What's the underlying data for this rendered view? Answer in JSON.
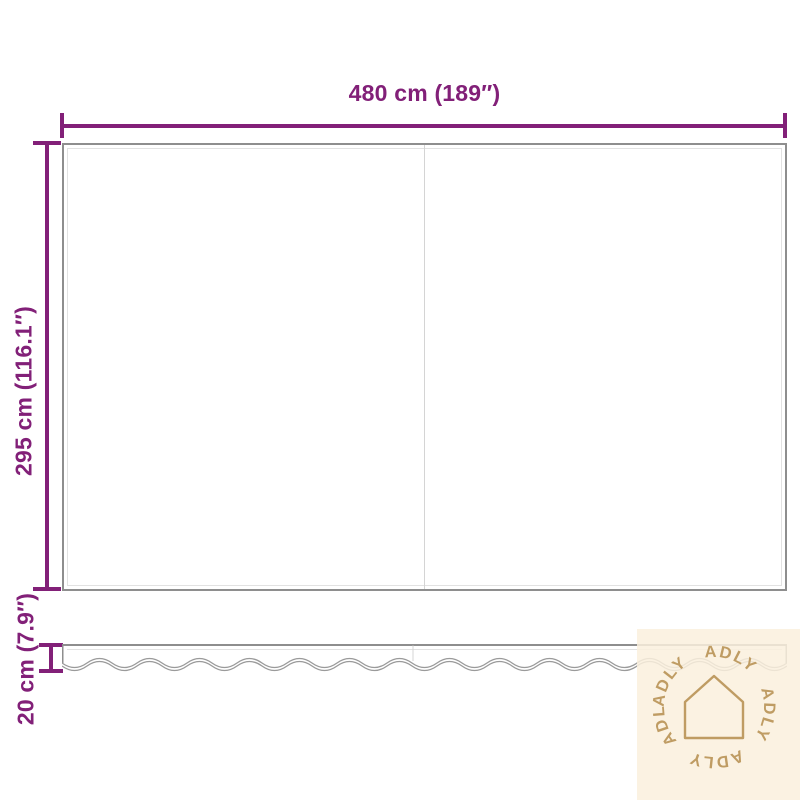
{
  "dimensions": {
    "width_label": "480 cm (189″)",
    "height_label": "295 cm (116.1″)",
    "valance_height_label": "20 cm (7.9″)"
  },
  "watermark": {
    "brand": "ADLY",
    "ring_text": "ADLY ADLY ADLY ADLY ADLY"
  },
  "colors": {
    "dimension_purple": "#822078",
    "outline_gray": "#8e8e8e",
    "inner_seam_gray": "#e2e2e2",
    "watermark_background": "#faf0dd",
    "watermark_accent": "#bf9c63"
  }
}
